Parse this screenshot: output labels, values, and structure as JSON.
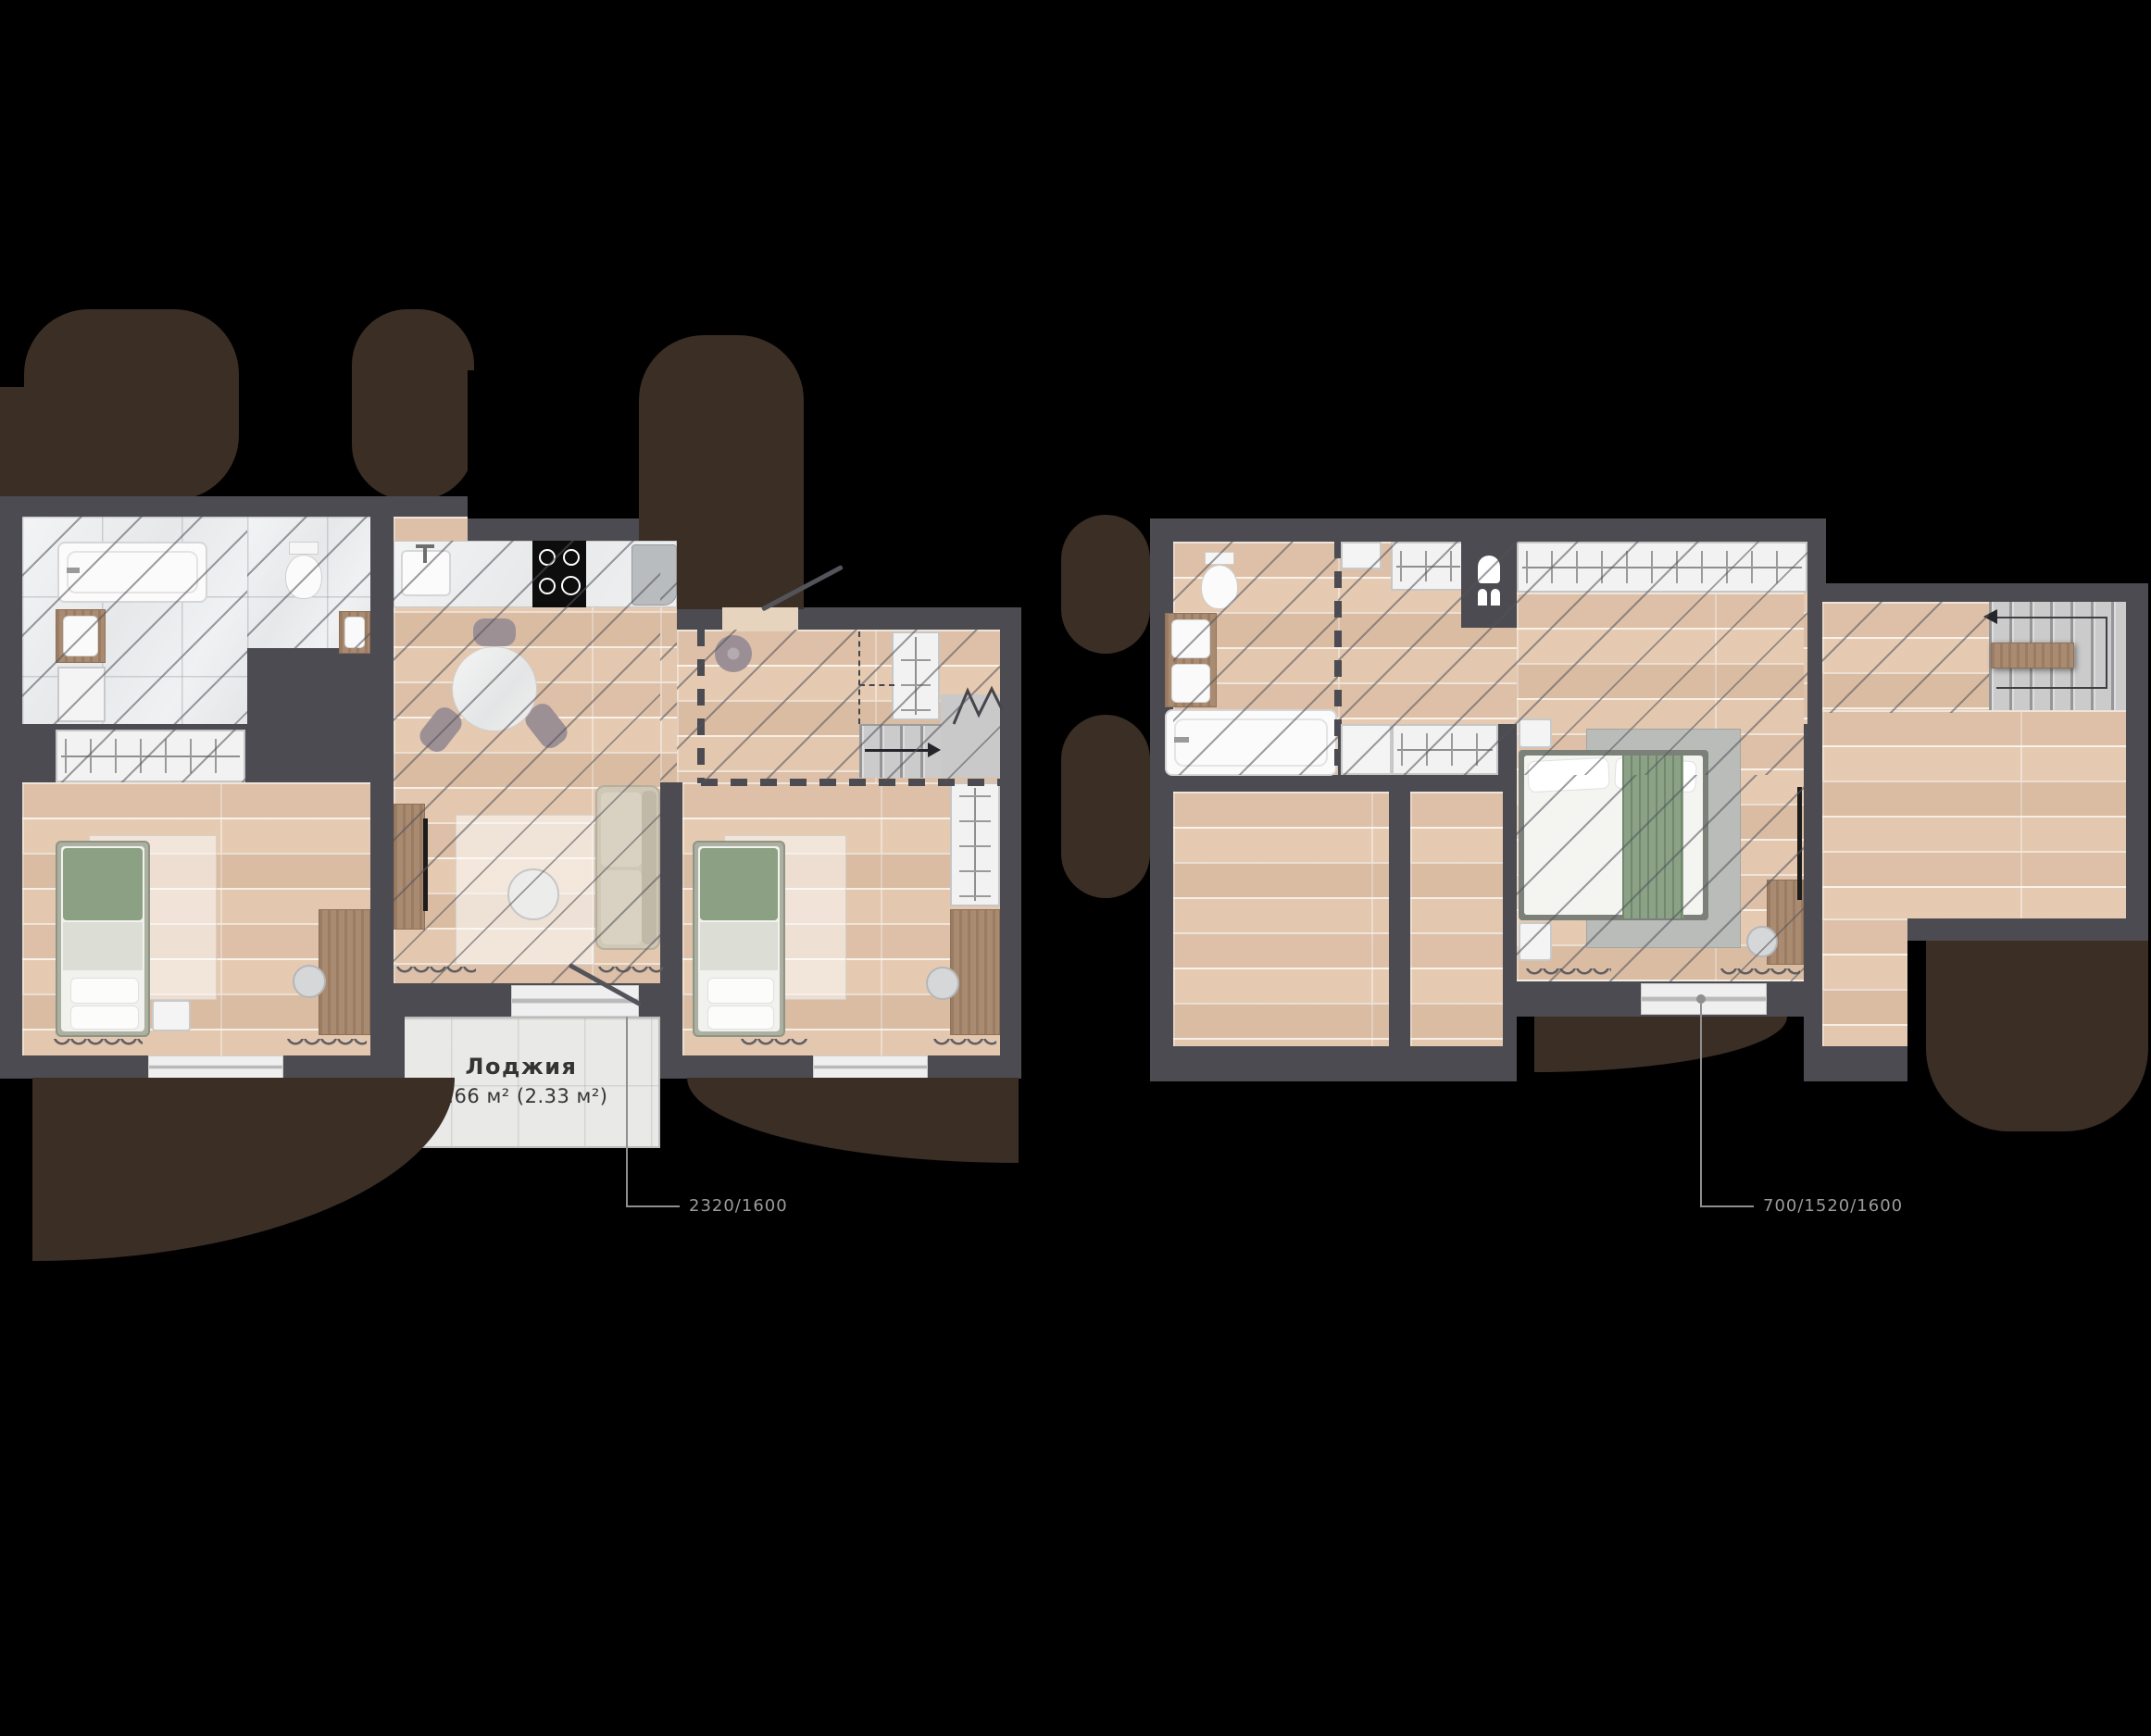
{
  "background_color": "#000000",
  "palette": {
    "wall": "#4b4b51",
    "wood_floor": "#e7ccb4",
    "tile_floor": "#eceded",
    "loggia_tile": "#e9e9e7",
    "hatch_line": "#52525a",
    "door_swing_brown": "#3b2e25",
    "stair_gray": "#c9c9c9",
    "bed_green": "#8ca183",
    "leader_gray": "#9b9b9b",
    "label_dark": "#343434"
  },
  "floor1": {
    "name": "first floor plan",
    "loggia": {
      "label": "Лоджия",
      "area": "4.66 м² (2.33 м²)"
    },
    "window_dimension": "2320/1600"
  },
  "floor2": {
    "name": "second floor plan",
    "window_dimension": "700/1520/1600"
  }
}
